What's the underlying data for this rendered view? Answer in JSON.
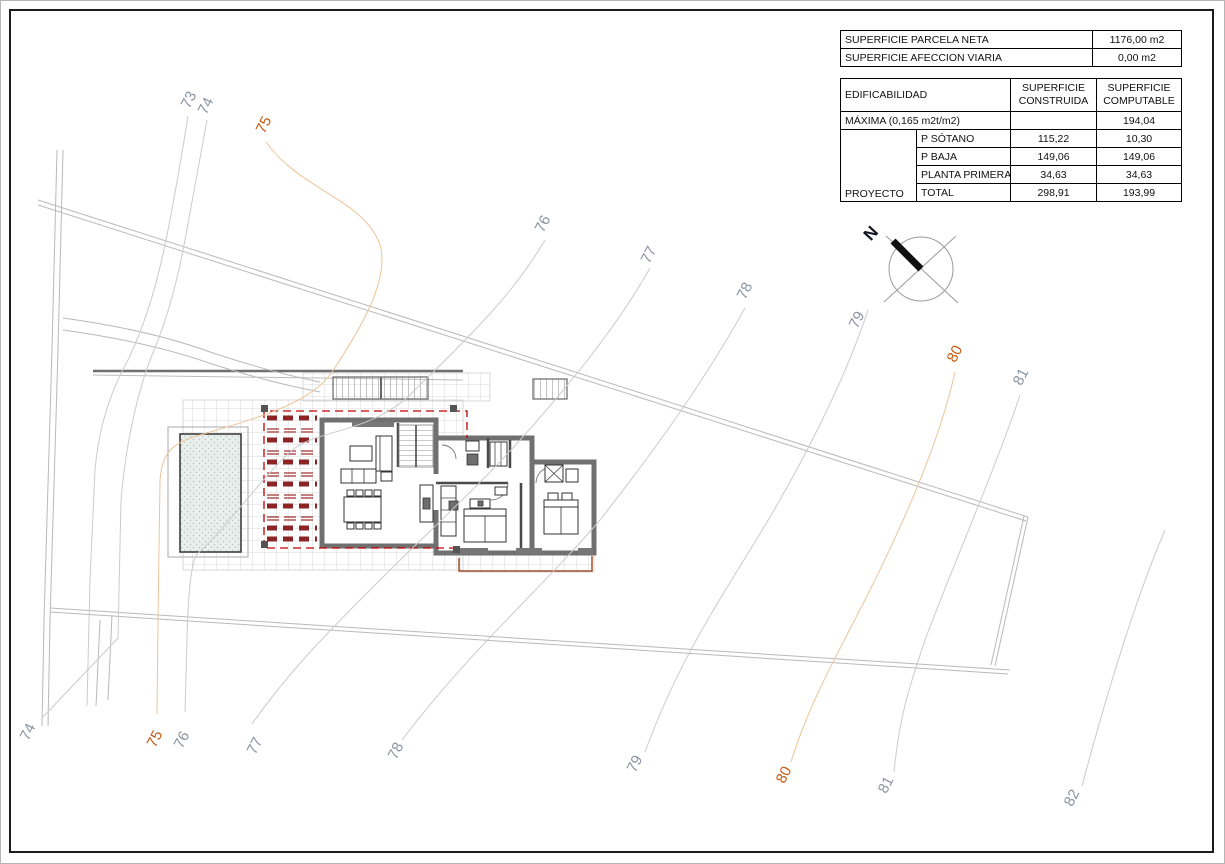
{
  "sheet": {
    "type": "architectural-site-plan"
  },
  "tables": {
    "parcel": {
      "rows": [
        {
          "label": "SUPERFICIE PARCELA NETA",
          "value": "1176,00 m2"
        },
        {
          "label": "SUPERFICIE AFECCION VIARIA",
          "value": "0,00 m2"
        }
      ]
    },
    "edif": {
      "header": {
        "c1": "EDIFICABILIDAD",
        "c2": "SUPERFICIE\nCONSTRUIDA",
        "c3": "SUPERFICIE\nCOMPUTABLE"
      },
      "maxima": {
        "label": "MÁXIMA (0,165 m2t/m2)",
        "construida": "",
        "computable": "194,04"
      },
      "group_label": "PROYECTO",
      "rows": [
        {
          "label": "P SÓTANO",
          "construida": "115,22",
          "computable": "10,30"
        },
        {
          "label": "P BAJA",
          "construida": "149,06",
          "computable": "149,06"
        },
        {
          "label": "PLANTA PRIMERA",
          "construida": "34,63",
          "computable": "34,63"
        },
        {
          "label": "TOTAL",
          "construida": "298,91",
          "computable": "193,99"
        }
      ]
    }
  },
  "compass": {
    "label": "N"
  },
  "contours": {
    "top": [
      {
        "v": "73"
      },
      {
        "v": "74"
      },
      {
        "v": "75"
      },
      {
        "v": "76"
      },
      {
        "v": "77"
      },
      {
        "v": "78"
      },
      {
        "v": "79"
      },
      {
        "v": "80"
      },
      {
        "v": "81"
      }
    ],
    "bottom": [
      {
        "v": "74"
      },
      {
        "v": "75"
      },
      {
        "v": "76"
      },
      {
        "v": "77"
      },
      {
        "v": "78"
      },
      {
        "v": "79"
      },
      {
        "v": "80"
      },
      {
        "v": "81"
      },
      {
        "v": "82"
      }
    ]
  },
  "colors": {
    "label_gray": "#8b95a3",
    "label_orange": "#c55a11",
    "contour_gray": "#cbcbcb",
    "contour_orange": "#ecc49a",
    "wall_gray": "#707070",
    "pergola_slat_red": "#8b2525",
    "outline_dashed_red": "#c00000",
    "roof_brown": "#a0522d",
    "pool_fill": "#e8efec"
  }
}
